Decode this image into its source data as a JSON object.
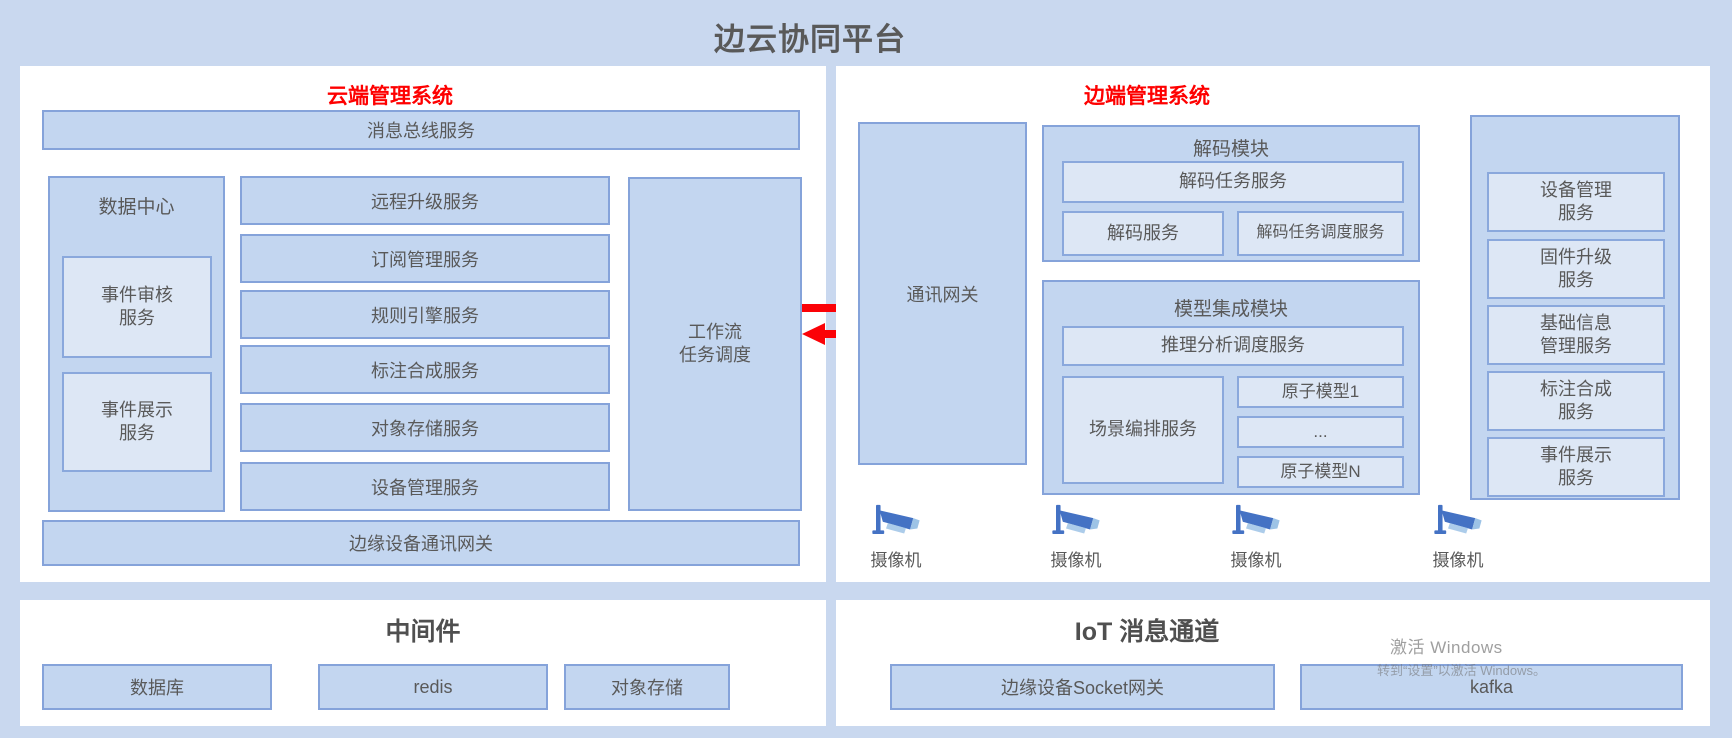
{
  "title": "边云协同平台",
  "colors": {
    "background": "#c9d8ef",
    "panel": "#ffffff",
    "box_fill": "#c3d6f0",
    "box_border": "#85a3da",
    "light_box_fill": "#dde7f5",
    "text_gray": "#595959",
    "header_red": "#fe0000",
    "arrow_red": "#fb0207",
    "camera_blue": "#4472c4",
    "camera_light_blue": "#9dc3e6"
  },
  "cloud_panel": {
    "header": "云端管理系统",
    "bus_service": "消息总线服务",
    "data_center": {
      "label": "数据中心",
      "box1": {
        "l1": "事件审核",
        "l2": "服务"
      },
      "box2": {
        "l1": "事件展示",
        "l2": "服务"
      }
    },
    "services": [
      "远程升级服务",
      "订阅管理服务",
      "规则引擎服务",
      "标注合成服务",
      "对象存储服务",
      "设备管理服务"
    ],
    "workflow": {
      "l1": "工作流",
      "l2": "任务调度"
    },
    "edge_gateway": "边缘设备通讯网关"
  },
  "middleware_panel": {
    "title": "中间件",
    "items": [
      "数据库",
      "redis",
      "对象存储"
    ]
  },
  "edge_panel": {
    "header": "边端管理系统",
    "comm_gateway": "通讯网关",
    "decode_module": {
      "label": "解码模块",
      "task_service": "解码任务服务",
      "decode_service": "解码服务",
      "scheduler_service": "解码任务调度服务"
    },
    "model_module": {
      "label": "模型集成模块",
      "inference_service": "推理分析调度服务",
      "scene_service": "场景编排服务",
      "models": [
        "原子模型1",
        "...",
        "原子模型N"
      ]
    },
    "device_column": [
      {
        "l1": "设备管理",
        "l2": "服务"
      },
      {
        "l1": "固件升级",
        "l2": "服务"
      },
      {
        "l1": "基础信息",
        "l2": "管理服务"
      },
      {
        "l1": "标注合成",
        "l2": "服务"
      },
      {
        "l1": "事件展示",
        "l2": "服务"
      }
    ],
    "cameras": [
      "摄像机",
      "摄像机",
      "摄像机",
      "摄像机"
    ]
  },
  "iot_panel": {
    "title": "IoT 消息通道",
    "items": [
      "边缘设备Socket网关",
      "kafka"
    ]
  },
  "watermark": {
    "line1": "激活 Windows",
    "line2": "转到“设置”以激活 Windows。"
  }
}
